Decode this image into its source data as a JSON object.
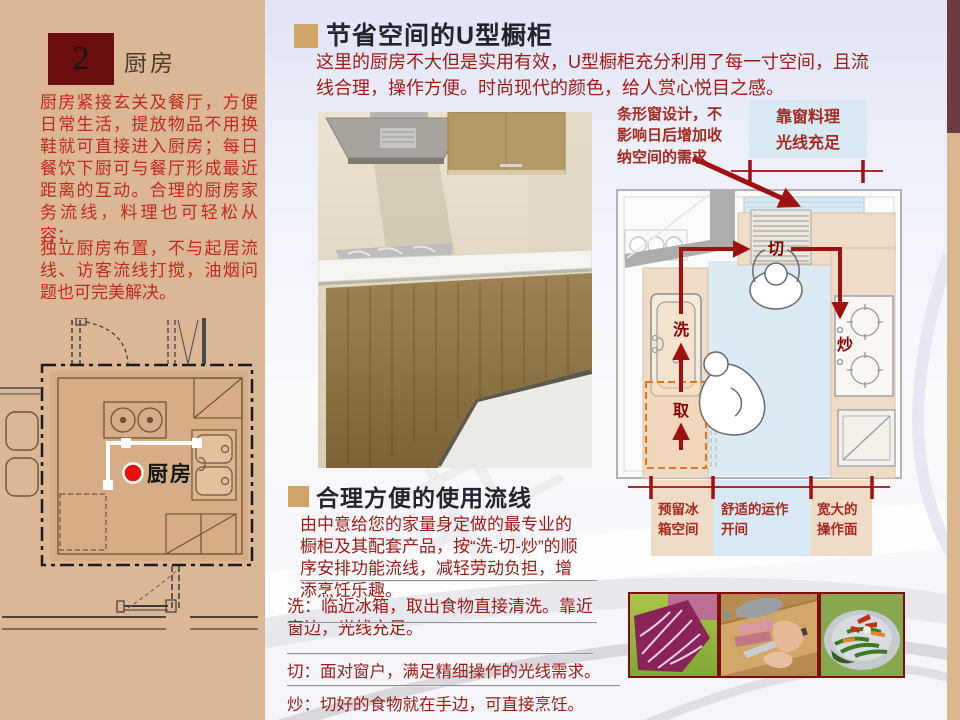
{
  "colors": {
    "sidebar_bg": "#DCB795",
    "badge_maroon": "#6A0E10",
    "bullet_gold": "#CFA567",
    "body_red": "#9E1A15",
    "sidebar_text_red": "#BE2A1D",
    "diagram_arrow_red": "#A01010",
    "station_label_red": "#8B0000",
    "zone_blue": "#D9E9F3",
    "zone_tan": "#F0DCC6",
    "edge_bar_maroon": "#6E3B40",
    "edge_bar_tan": "#DBB78F"
  },
  "sidebar": {
    "number": "2",
    "title": "厨房",
    "para1": "厨房紧接玄关及餐厅，方便日常生活，提放物品不用换鞋就可直接进入厨房；每日餐饮下厨可与餐厅形成最近距离的互动。合理的厨房家务流线，料理也可轻松从容；",
    "para2": "独立厨房布置，不与起居流线、访客流线打搅，油烟问题也可完美解决。",
    "plan_room_label": "厨房"
  },
  "section1": {
    "title": "节省空间的U型橱柜",
    "body": "这里的厨房不大但是实用有效，U型橱柜充分利用了每一寸空间，且流线合理，操作方便。时尚现代的颜色，给人赏心悦目之感。"
  },
  "diagram": {
    "callout_window": "条形窗设计，不影响日后增加收纳空间的需求",
    "callout_light_line1": "靠窗料理",
    "callout_light_line2": "光线充足",
    "station_cut": "切",
    "station_wash": "洗",
    "station_fry": "炒",
    "station_take": "取",
    "dim_fridge": "预留冰箱空间",
    "dim_work": "舒适的运作开间",
    "dim_counter": "宽大的操作面"
  },
  "section2": {
    "title": "合理方便的使用流线",
    "body": "由中意给您的家量身定做的最专业的橱柜及其配套产品，按“洗-切-炒”的顺序安排功能流线，减轻劳动负担，增添烹饪乐趣。",
    "items": [
      "洗：临近冰箱，取出食物直接清洗。靠近窗边，光线充足。",
      "切：面对窗户，满足精细操作的光线需求。",
      "炒：切好的食物就在手边，可直接烹饪。"
    ]
  }
}
